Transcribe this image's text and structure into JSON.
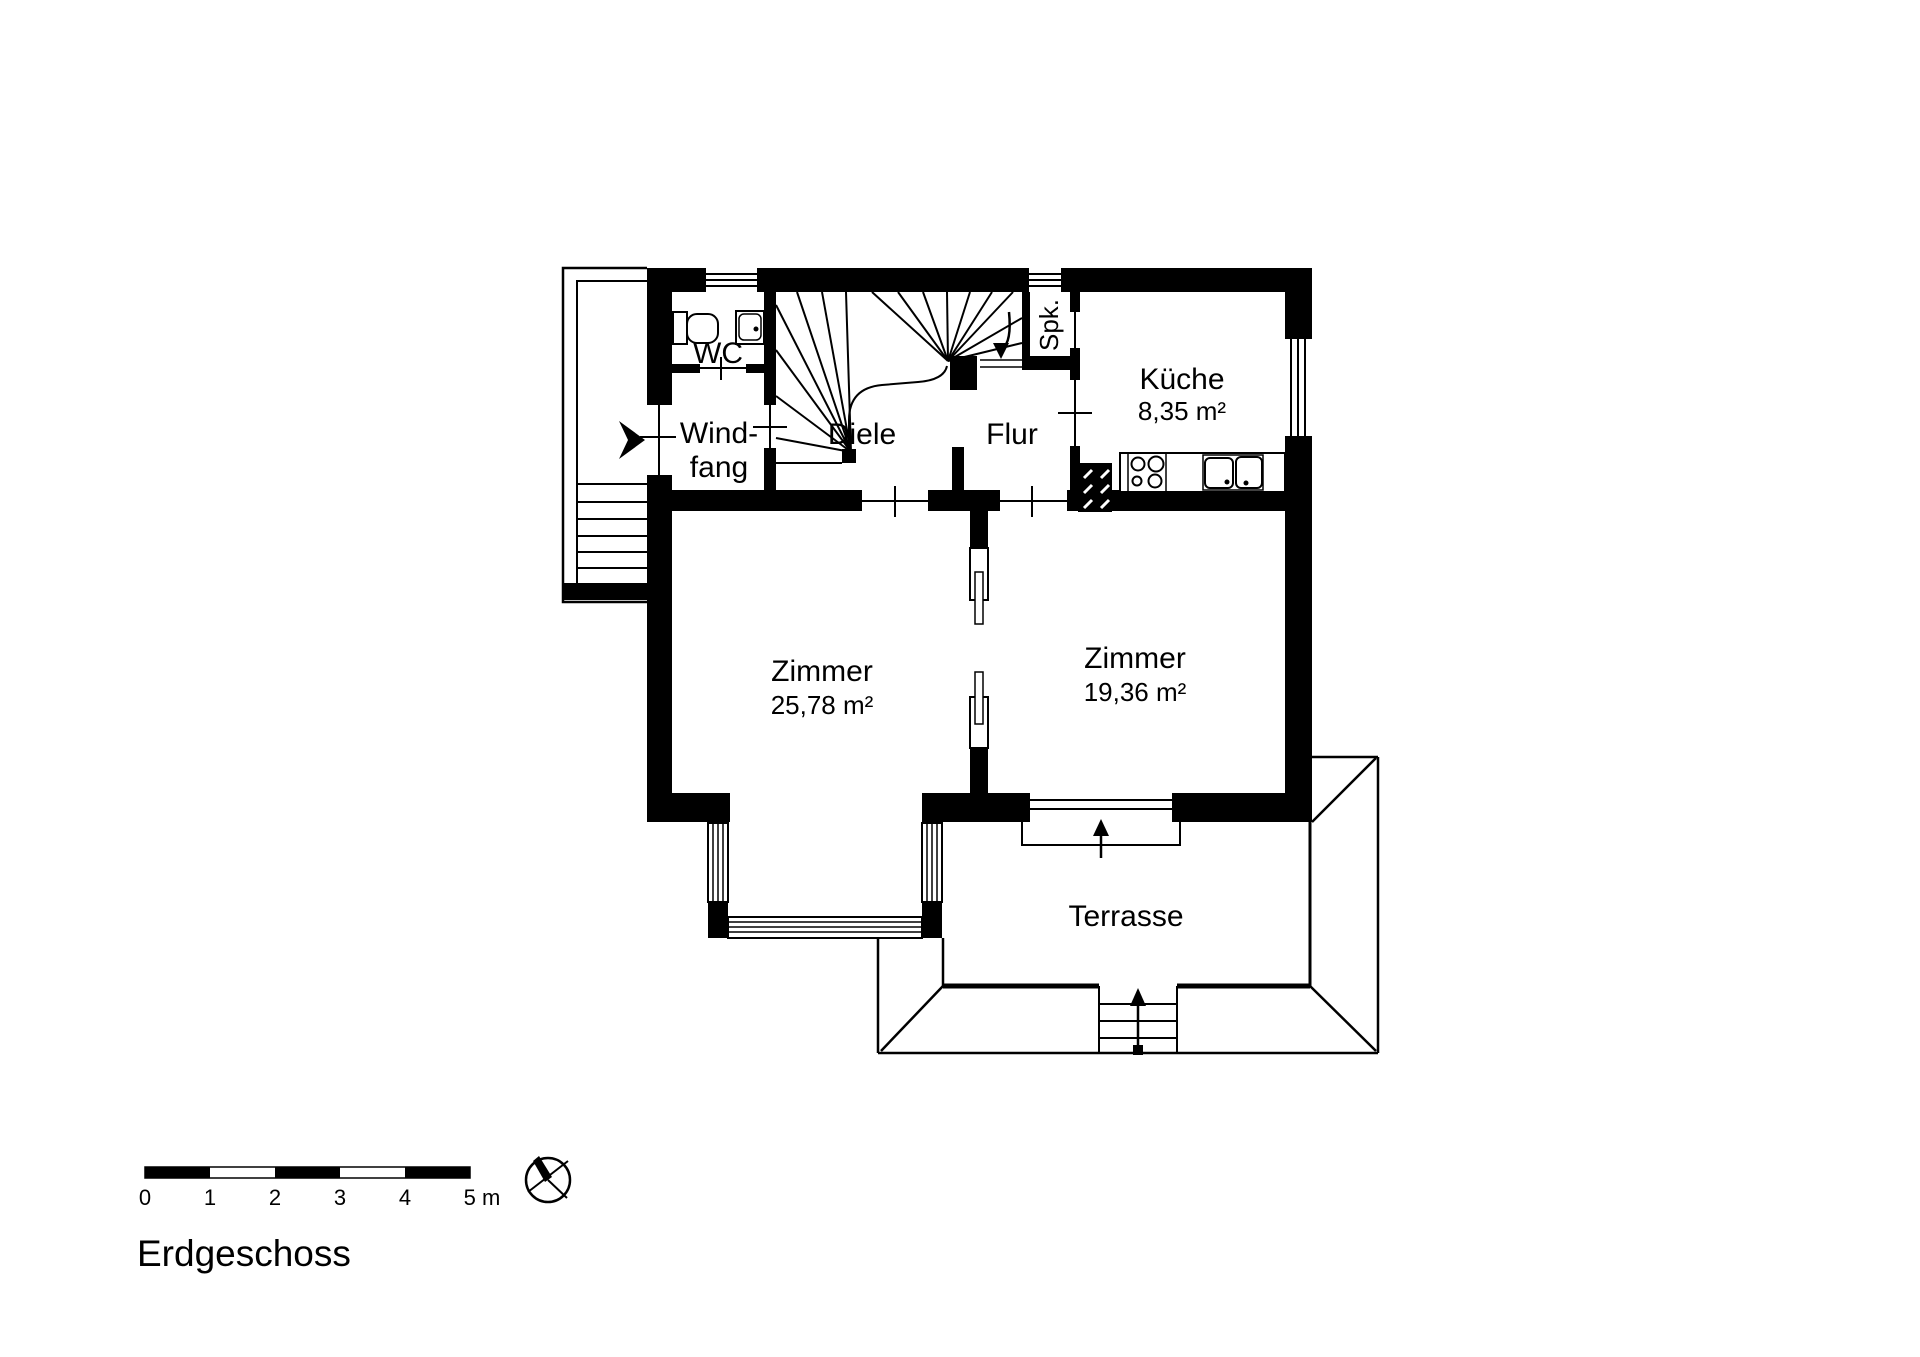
{
  "floor_label": "Erdgeschoss",
  "rooms": {
    "wc": {
      "label": "WC"
    },
    "windfang": {
      "line1": "Wind-",
      "line2": "fang"
    },
    "diele": {
      "label": "Diele"
    },
    "flur": {
      "label": "Flur"
    },
    "spk": {
      "label": "Spk."
    },
    "kueche": {
      "label": "Küche",
      "area": "8,35 m²"
    },
    "zimmer_links": {
      "label": "Zimmer",
      "area": "25,78 m²"
    },
    "zimmer_rechts": {
      "label": "Zimmer",
      "area": "19,36 m²"
    },
    "terrasse": {
      "label": "Terrasse"
    }
  },
  "scale_bar": {
    "ticks": [
      "0",
      "1",
      "2",
      "3",
      "4"
    ],
    "end_label": "5 m"
  },
  "colors": {
    "ink": "#000000",
    "paper": "#ffffff"
  }
}
